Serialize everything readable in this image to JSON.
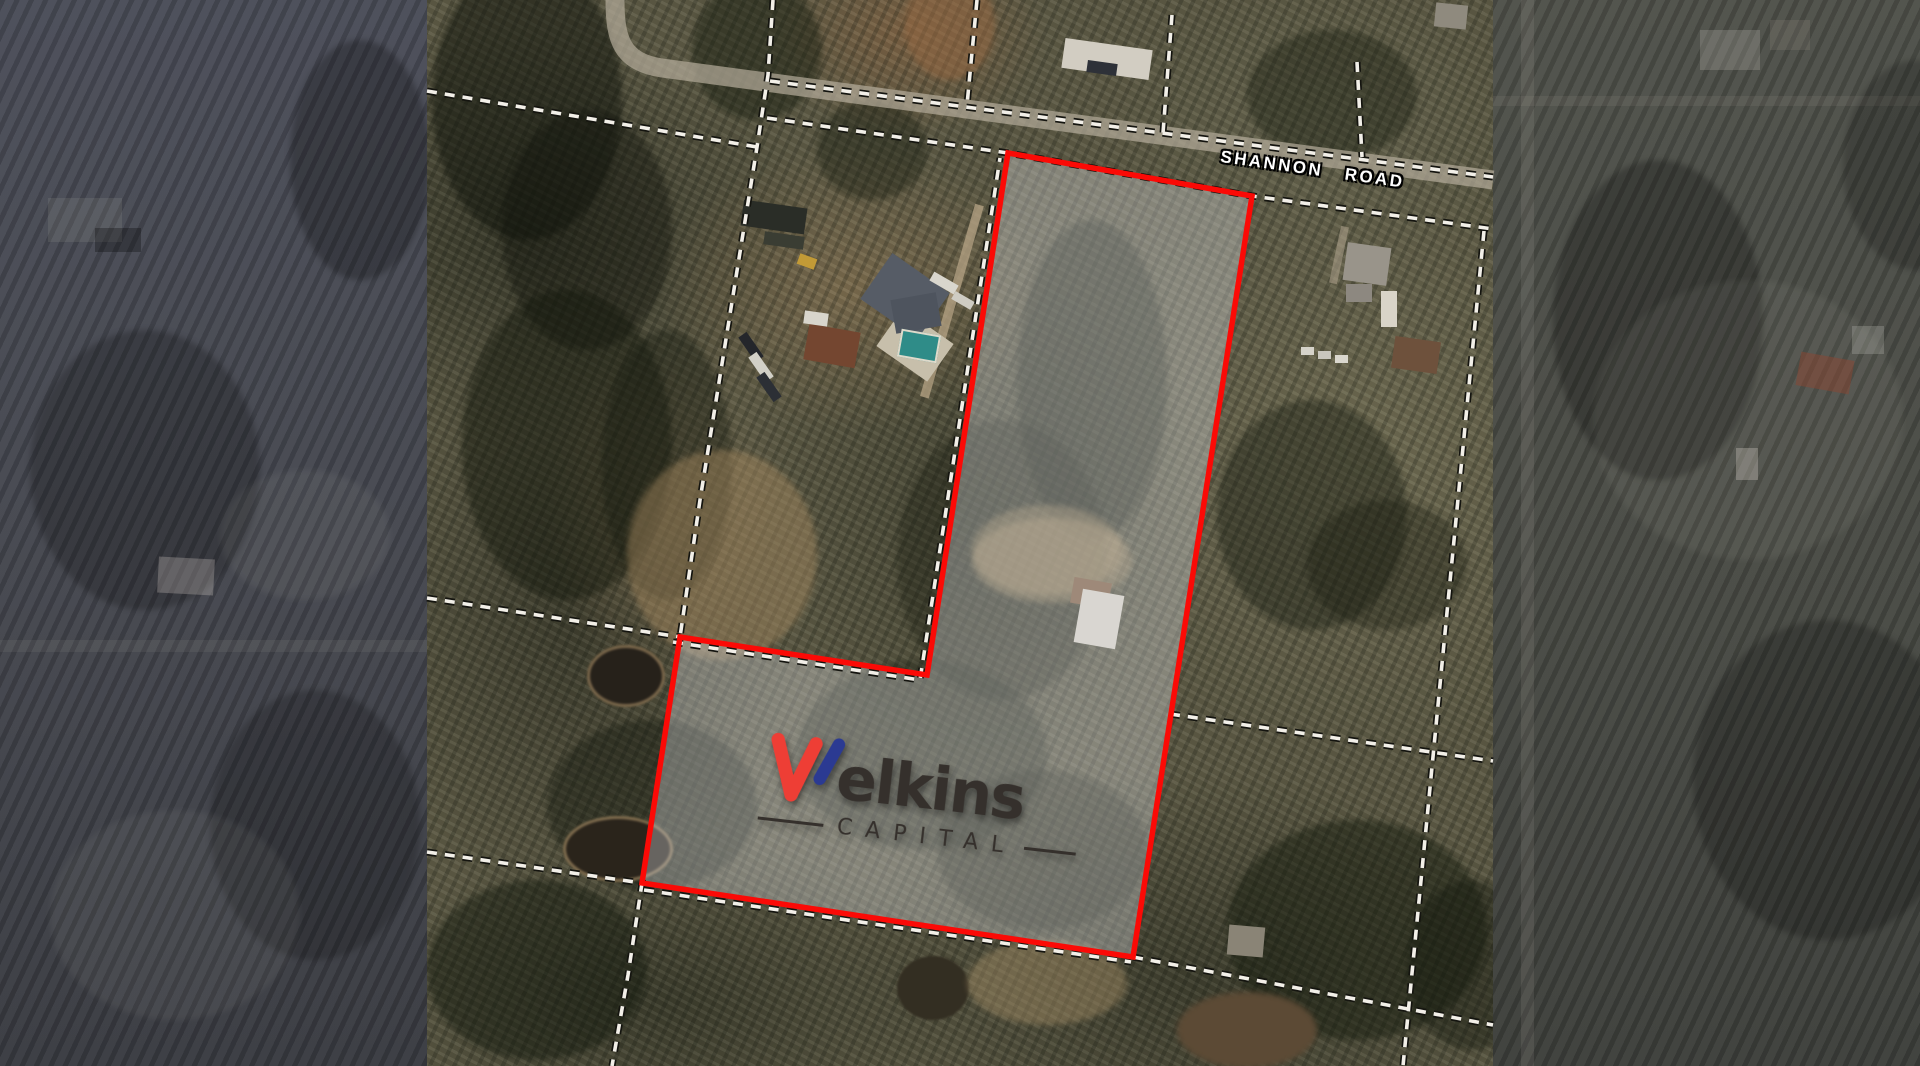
{
  "map": {
    "road_label": {
      "word1": "SHANNON",
      "word2": "ROAD"
    },
    "boundary_color": "#fb0a06",
    "parcel_fill_color": "#dee2e8",
    "cadastral_dash_color": "#f2efe8",
    "cadastral_casing_color": "#14140f"
  },
  "logo": {
    "wordmark": "Welkins",
    "wordmark_tail": "elkins",
    "subtitle": "CAPITAL",
    "mark_red": "#ee3e35",
    "mark_blue": "#2b3a92",
    "text_color": "#35302c"
  }
}
